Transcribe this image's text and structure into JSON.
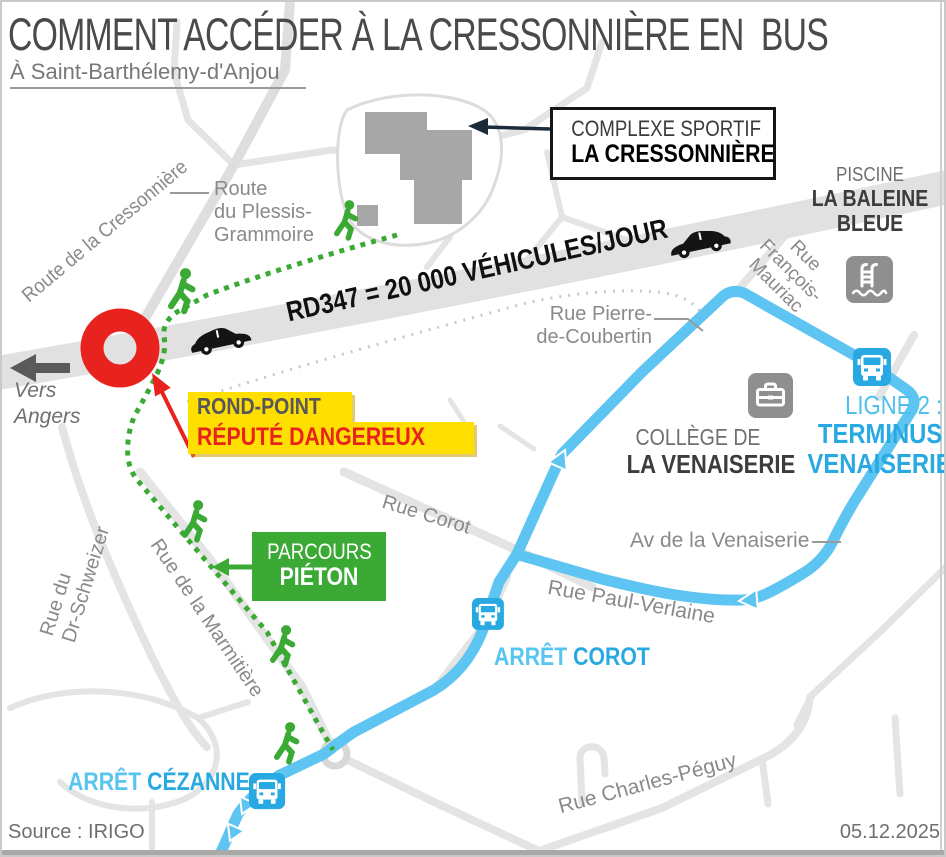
{
  "header": {
    "title": "COMMENT ACCÉDER À LA CRESSONNIÈRE EN  BUS",
    "subtitle": "À Saint-Barthélemy-d'Anjou"
  },
  "footer": {
    "source": "Source : IRIGO",
    "date": "05.12.2025"
  },
  "callouts": {
    "complexe": {
      "line1": "COMPLEXE SPORTIF",
      "line2": "LA CRESSONNIÈRE"
    },
    "piscine": {
      "line1": "PISCINE",
      "line2": "LA BALEINE",
      "line3": "BLEUE"
    },
    "rondpoint": {
      "line1": "ROND-POINT",
      "line2": "RÉPUTÉ DANGEREUX"
    },
    "parcours": {
      "line1": "PARCOURS",
      "line2": "PIÉTON"
    },
    "college": {
      "line1": "COLLÈGE DE",
      "line2": "LA VENAISERIE"
    },
    "ligne2": {
      "line1": "LIGNE 2 :",
      "line2": "TERMINUS",
      "line3": "VENAISERIE"
    },
    "arret_corot": {
      "prefix": "ARRÊT ",
      "name": "COROT"
    },
    "arret_cezanne": {
      "prefix": "ARRÊT ",
      "name": "CÉZANNE"
    },
    "traffic": "RD347 = 20 000 VÉHICULES/JOUR",
    "direction": {
      "line1": "Vers",
      "line2": "Angers"
    }
  },
  "streets": {
    "cressonniere": "Route de la Cressonnière",
    "plessis": {
      "line1": "Route",
      "line2": "du Plessis-",
      "line3": "Grammoire"
    },
    "coubertin": {
      "line1": "Rue Pierre-",
      "line2": "de-Coubertin"
    },
    "francois_mauriac": {
      "line1": "Rue",
      "line2": "François-",
      "line3": "Mauriac"
    },
    "corot": "Rue Corot",
    "av_venaiserie": "Av de la Venaiserie",
    "paul_verlaine": "Rue Paul-Verlaine",
    "marmitiere": "Rue de la Marmitière",
    "schweizer": {
      "line1": "Rue du",
      "line2": "Dr-Schweizer"
    },
    "charles_peguy": "Rue Charles-Péguy"
  },
  "colors": {
    "route_blue": "#5ec4f1",
    "stop_blue": "#29a9e1",
    "green": "#3aaa35",
    "red": "#e8231d",
    "yellow": "#ffdf00",
    "road_gray": "#e2e2e2",
    "icon_gray": "#8f8f8f",
    "text_gray": "#8a8a8a",
    "dark": "#3c3c3c"
  }
}
